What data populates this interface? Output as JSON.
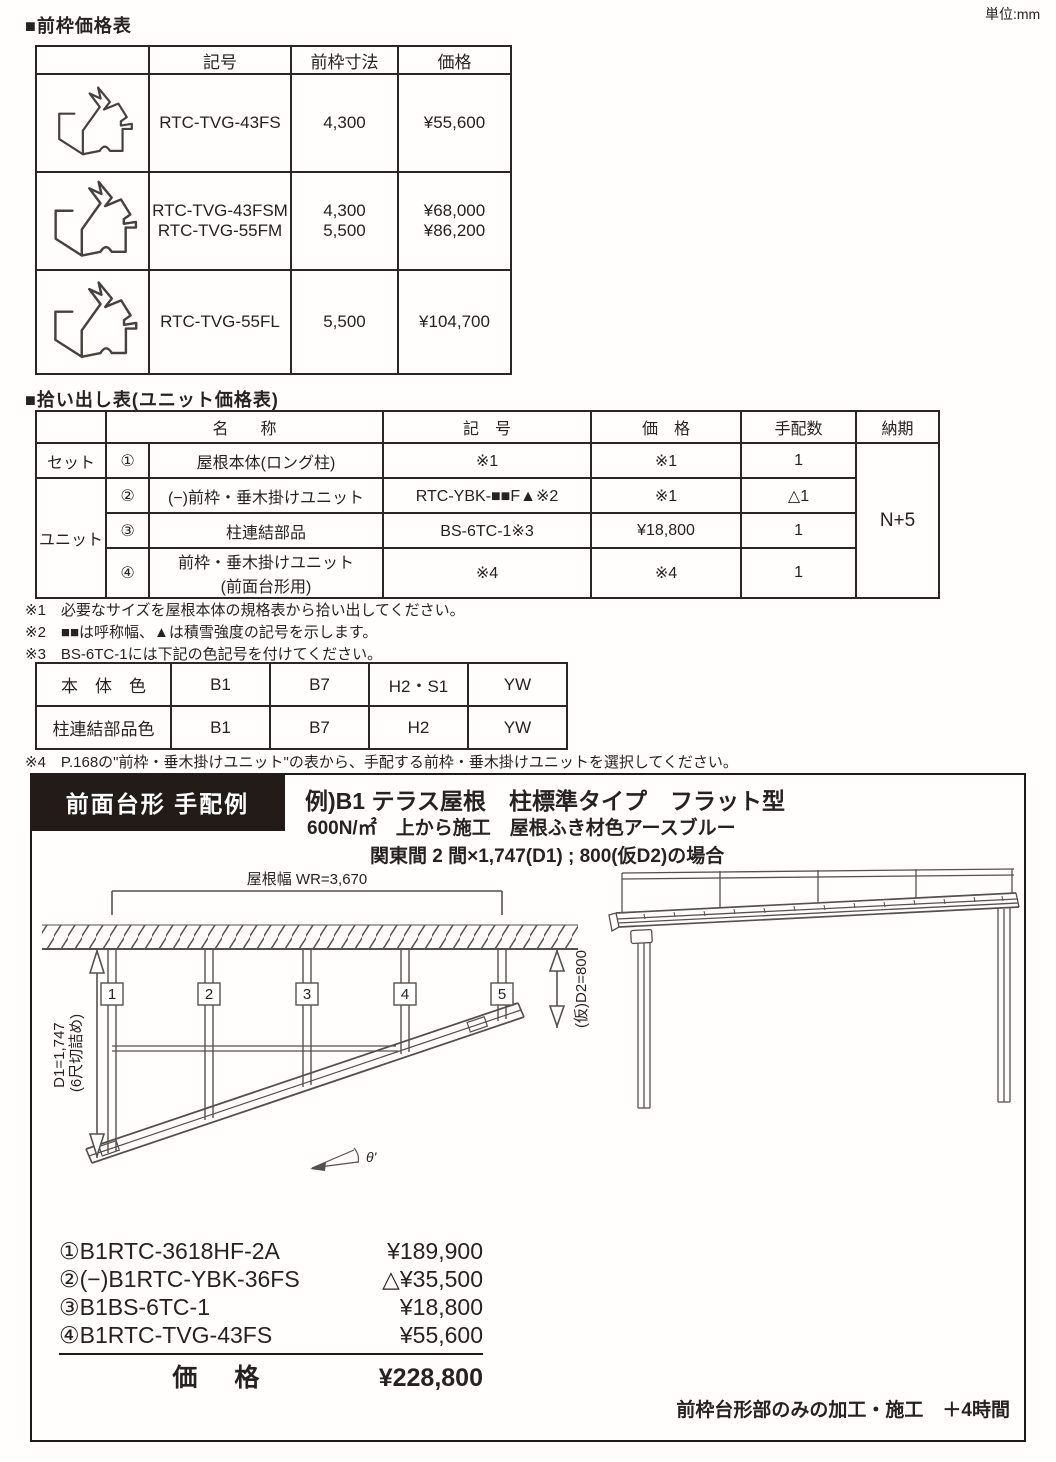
{
  "page": {
    "unit_label": "単位:mm"
  },
  "front_frame_table": {
    "heading": "■前枠価格表",
    "headers": {
      "symbol": "記号",
      "dimension": "前枠寸法",
      "price": "価格"
    },
    "rows": [
      {
        "symbols": [
          "RTC-TVG-43FS"
        ],
        "dimensions": [
          "4,300"
        ],
        "prices": [
          "¥55,600"
        ]
      },
      {
        "symbols": [
          "RTC-TVG-43FSM",
          "RTC-TVG-55FM"
        ],
        "dimensions": [
          "4,300",
          "5,500"
        ],
        "prices": [
          "¥68,000",
          "¥86,200"
        ]
      },
      {
        "symbols": [
          "RTC-TVG-55FL"
        ],
        "dimensions": [
          "5,500"
        ],
        "prices": [
          "¥104,700"
        ]
      }
    ]
  },
  "pickup_table": {
    "heading": "■拾い出し表(ユニット価格表)",
    "headers": {
      "name": "名　　称",
      "symbol": "記　号",
      "price": "価　格",
      "qty": "手配数",
      "delivery": "納期"
    },
    "groups": {
      "set": "セット",
      "unit": "ユニット"
    },
    "rows": [
      {
        "no": "①",
        "name": "屋根本体(ロング柱)",
        "symbol": "※1",
        "price": "※1",
        "qty": "1"
      },
      {
        "no": "②",
        "name": "(−)前枠・垂木掛けユニット",
        "symbol": "RTC-YBK-■■F▲※2",
        "price": "※1",
        "qty": "△1"
      },
      {
        "no": "③",
        "name": "柱連結部品",
        "symbol": "BS-6TC-1※3",
        "price": "¥18,800",
        "qty": "1"
      },
      {
        "no": "④",
        "name": "前枠・垂木掛けユニット",
        "name2": "(前面台形用)",
        "symbol": "※4",
        "price": "※4",
        "qty": "1"
      }
    ],
    "delivery_value": "N+5"
  },
  "notes": [
    "※1　必要なサイズを屋根本体の規格表から拾い出してください。",
    "※2　■■は呼称幅、▲は積雪強度の記号を示します。",
    "※3　BS-6TC-1には下記の色記号を付けてください。"
  ],
  "color_table": {
    "rows": [
      {
        "label": "本　体　色",
        "values": [
          "B1",
          "B7",
          "H2・S1",
          "YW"
        ]
      },
      {
        "label": "柱連結部品色",
        "values": [
          "B1",
          "B7",
          "H2",
          "YW"
        ]
      }
    ]
  },
  "note4": "※4　P.168の\"前枠・垂木掛けユニット\"の表から、手配する前枠・垂木掛けユニットを選択してください。",
  "example_box": {
    "title": "前面台形 手配例",
    "line1": "例)B1 テラス屋根　柱標準タイプ　フラット型",
    "line2": "600N/㎡　上から施工　屋根ふき材色アースブルー",
    "line3": "関東間 2 間×1,747(D1) ; 800(仮D2)の場合",
    "diagram": {
      "roof_width_label": "屋根幅 WR=3,670",
      "post_numbers": [
        "1",
        "2",
        "3",
        "4",
        "5"
      ],
      "d1_label": "D1=1,747",
      "d1_label2": "(6尺切詰め)",
      "d2_label": "(仮)D2=800",
      "angle_label": "θ'"
    },
    "price_list": {
      "items": [
        {
          "name": "①B1RTC-3618HF-2A",
          "price": "¥189,900"
        },
        {
          "name": "②(−)B1RTC-YBK-36FS",
          "price": "△¥35,500"
        },
        {
          "name": "③B1BS-6TC-1",
          "price": "¥18,800"
        },
        {
          "name": "④B1RTC-TVG-43FS",
          "price": "¥55,600"
        }
      ],
      "total_label": "価　格",
      "total_price": "¥228,800"
    },
    "footer_note": "前枠台形部のみの加工・施工　＋4時間"
  },
  "colors": {
    "ink": "#262220",
    "title_box_bg": "#221b17",
    "line": "#55504d"
  }
}
